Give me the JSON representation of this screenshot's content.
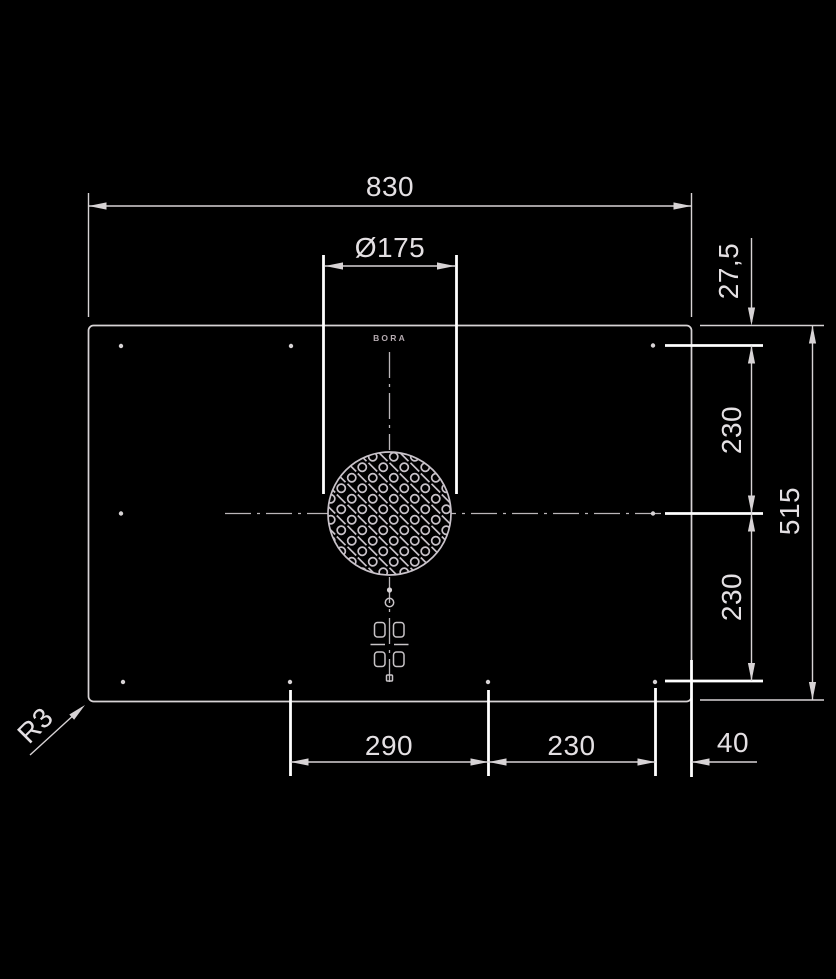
{
  "drawing": {
    "title": "cooktop-installation-drawing",
    "labels": {
      "overall_width": "830",
      "inlet_diameter": "Ø175",
      "top_offset": "27,5",
      "right_upper_segment": "230",
      "right_lower_segment": "230",
      "overall_depth": "515",
      "bottom_left_segment": "290",
      "bottom_center_segment": "230",
      "bottom_right_segment": "40",
      "corner_radius": "R3",
      "brand": "BORA"
    },
    "colors": {
      "background": "#000000",
      "line": "#d7d3d5",
      "text": "#e4e0e3",
      "bright": "#ffffff",
      "grille": "#c9c3ca",
      "accent": "#b5aab0"
    }
  }
}
